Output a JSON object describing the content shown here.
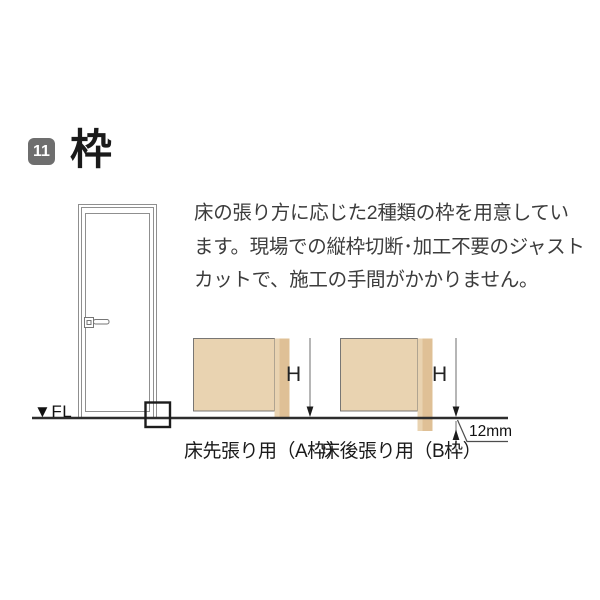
{
  "header": {
    "badge_number": "11",
    "title": "枠"
  },
  "description": {
    "lines": [
      "床の張り方に応じた2種類の枠を用意してい",
      "ます。現場での縦枠切断･加工不要のジャスト",
      "カットで、施工の手間がかかりません。"
    ]
  },
  "door_figure": {
    "floor_label": "▼FL"
  },
  "diagrams": {
    "a": {
      "height_label": "H",
      "caption": "床先張り用（A枠）"
    },
    "b": {
      "height_label": "H",
      "caption": "床後張り用（B枠）",
      "offset_label": "12mm"
    }
  },
  "colors": {
    "badge_bg": "#6e6e6e",
    "wall_fill": "#e9d3b1",
    "frame_fill": "#dfc096",
    "outline_dark": "#4d4d4d",
    "door_line": "#8f8f8f",
    "floor_line": "#2d2d2d",
    "dimension_line": "#8f8f8f"
  }
}
